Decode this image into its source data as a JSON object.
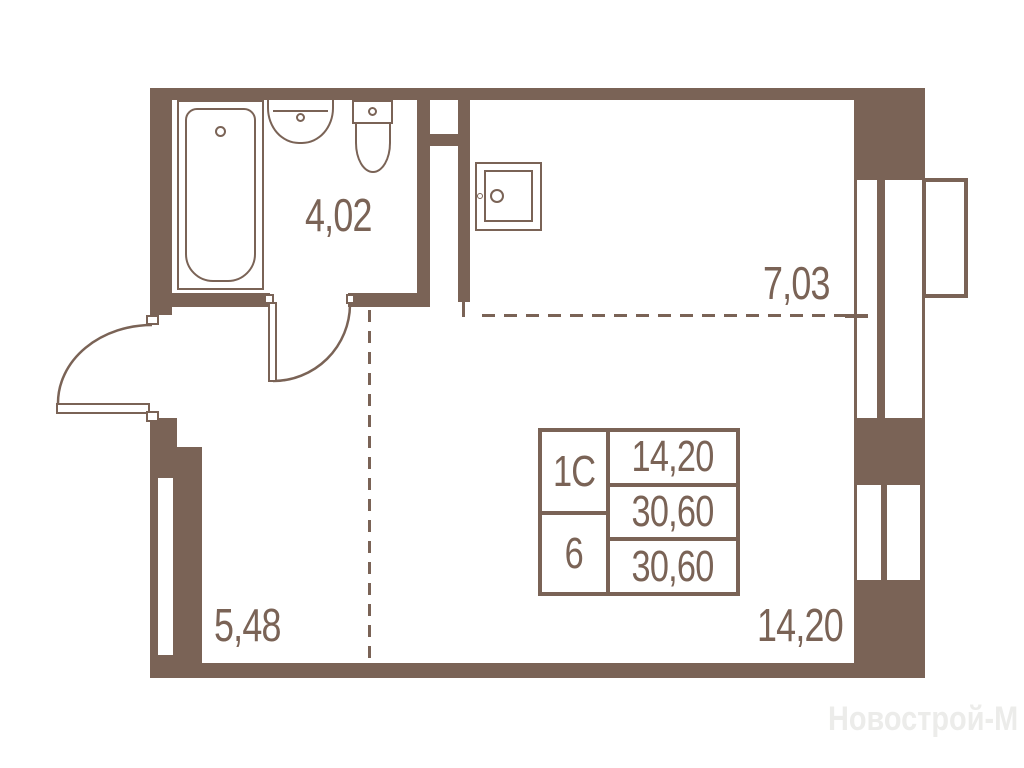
{
  "watermark": "Новострой-М",
  "colors": {
    "wall": "#7A6356",
    "text": "#7A6356",
    "watermark": "#ECECEA"
  },
  "rooms": {
    "bathroom": {
      "area": "4,02"
    },
    "kitchen": {
      "area": "7,03"
    },
    "hallway": {
      "area": "5,48"
    },
    "living": {
      "area": "14,20"
    }
  },
  "info_table": {
    "left": [
      "1С",
      "6"
    ],
    "right": [
      "14,20",
      "30,60",
      "30,60"
    ]
  },
  "fixtures": [
    "bathtub",
    "washbasin",
    "toilet",
    "kitchen-sink",
    "entrance-door",
    "bathroom-door",
    "window-upper",
    "window-lower",
    "balcony-sill"
  ]
}
